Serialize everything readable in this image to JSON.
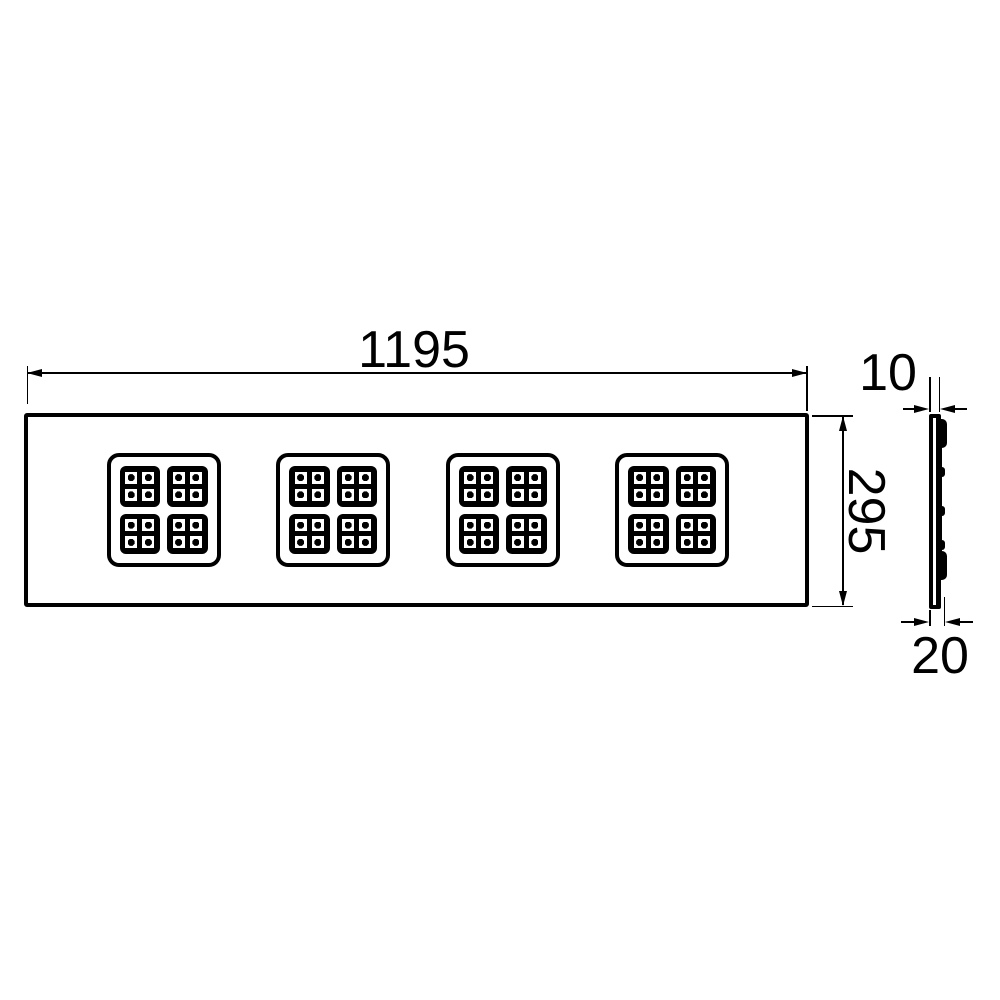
{
  "dimensions": {
    "width": "1195",
    "height": "295",
    "thickness": "10",
    "depth": "20"
  },
  "front_view": {
    "led_clusters": 4,
    "modules_per_cluster": 4,
    "leds_per_module": 4
  },
  "colors": {
    "line": "#000000",
    "background": "#ffffff"
  }
}
